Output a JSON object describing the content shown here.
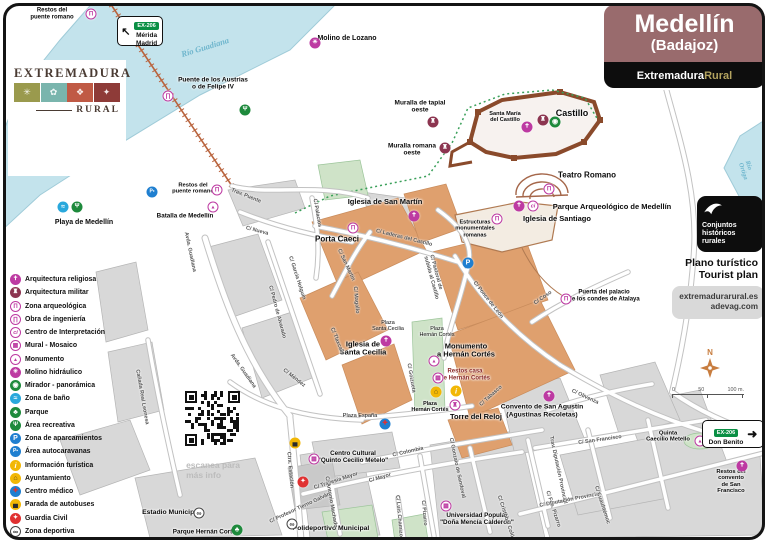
{
  "title": {
    "name": "Medellín",
    "region": "(Badajoz)",
    "brand_white": "Extremadura",
    "brand_gold": "Rural"
  },
  "panel": {
    "conjuntos": "Conjuntos\nhistóricos\nrurales",
    "plan": "Plano turístico\nTourist plan",
    "web1": "extremadurarural.es",
    "web2": "adevag.com"
  },
  "logos": {
    "extremadura": "EXTREMADURA",
    "rural": "RURAL",
    "redex": "redex",
    "redex_sub": "Red Extremeña de\nDesarrollo  Rural",
    "dip1": "DIPUTACIÓN",
    "dip2": "DE BADAJOZ",
    "tile_glyphs": [
      "✳",
      "✿",
      "❖",
      "✦"
    ]
  },
  "signs": [
    {
      "route": "EX-206",
      "lines": "Mérida\nMadrid",
      "arrow": "↖"
    },
    {
      "route": "EX-206",
      "lines": "Don Benito",
      "arrow": "➜"
    }
  ],
  "scale": {
    "north": "N",
    "t0": "0",
    "t50": "50",
    "t100": "100 m."
  },
  "qr_caption": "escanea para\nmás info",
  "rivers": [
    {
      "t": "Río Guadiana",
      "x": 205,
      "y": 47,
      "r": -17,
      "s": 8.5
    },
    {
      "t": "Río Ortiga",
      "x": 747,
      "y": 172,
      "r": 72,
      "s": 6.5
    }
  ],
  "icon_styles": {
    "religiosa": {
      "bg": "#bd3aa2",
      "fg": "#fff",
      "glyph": "✝"
    },
    "militar": {
      "bg": "#8c3550",
      "fg": "#fff",
      "glyph": "♜"
    },
    "arqueologica": {
      "bg": "#fff",
      "fg": "#bd3aa2",
      "br": "#bd3aa2",
      "glyph": "Π"
    },
    "ingenieria": {
      "bg": "#fff",
      "fg": "#bd3aa2",
      "br": "#bd3aa2",
      "glyph": "∏"
    },
    "ci": {
      "bg": "#fff",
      "fg": "#bd3aa2",
      "br": "#bd3aa2",
      "glyph": "ci",
      "it": 1,
      "fs": 5.5
    },
    "mural": {
      "bg": "#fff",
      "fg": "#bd3aa2",
      "br": "#bd3aa2",
      "glyph": "▦"
    },
    "monumento": {
      "bg": "#fff",
      "fg": "#bd3aa2",
      "br": "#bd3aa2",
      "glyph": "▲",
      "fs": 5
    },
    "torre": {
      "bg": "#fff",
      "fg": "#bd3aa2",
      "br": "#bd3aa2",
      "glyph": "♜"
    },
    "molino": {
      "bg": "#bd3aa2",
      "fg": "#fff",
      "glyph": "✳"
    },
    "mirador": {
      "bg": "#1e8a3c",
      "fg": "#fff",
      "glyph": "◉",
      "fs": 7
    },
    "bano": {
      "bg": "#29a8dc",
      "fg": "#fff",
      "glyph": "≈",
      "fs": 7
    },
    "parque": {
      "bg": "#1e8a3c",
      "fg": "#fff",
      "glyph": "♣",
      "fs": 7
    },
    "recreativa": {
      "bg": "#1e8a3c",
      "fg": "#fff",
      "glyph": "Ψ"
    },
    "aparcamiento": {
      "bg": "#1f7fd0",
      "fg": "#fff",
      "glyph": "P",
      "fs": 7
    },
    "autocaravana": {
      "bg": "#1f7fd0",
      "fg": "#fff",
      "glyph": "P▪",
      "fs": 5
    },
    "info": {
      "bg": "#f2b705",
      "fg": "#fff",
      "glyph": "i",
      "it": 1,
      "fs": 7.5
    },
    "ayuntamiento": {
      "bg": "#f2b705",
      "fg": "#5a4a1a",
      "glyph": "⌂",
      "fs": 7
    },
    "medico": {
      "bg": "#1f7fd0",
      "fg": "#e03131",
      "glyph": "✚"
    },
    "bus": {
      "bg": "#f2b705",
      "fg": "#2b2b2b",
      "glyph": "▄",
      "fs": 7
    },
    "guardia": {
      "bg": "#e03131",
      "fg": "#fff",
      "glyph": "✦"
    },
    "deportiva": {
      "bg": "#fff",
      "fg": "#222",
      "br": "#444",
      "glyph": "∞",
      "fs": 7
    }
  },
  "legend": {
    "items": [
      {
        "type": "religiosa",
        "label": "Arquitectura religiosa"
      },
      {
        "type": "militar",
        "label": "Arquitectura militar"
      },
      {
        "type": "arqueologica",
        "label": "Zona arqueológica"
      },
      {
        "type": "ingenieria",
        "label": "Obra de ingeniería"
      },
      {
        "type": "ci",
        "label": "Centro de Interpretación"
      },
      {
        "type": "mural",
        "label": "Mural - Mosaico"
      },
      {
        "type": "monumento",
        "label": "Monumento"
      },
      {
        "type": "molino",
        "label": "Molino hidráulico"
      },
      {
        "type": "mirador",
        "label": "Mirador - panorámica"
      },
      {
        "type": "bano",
        "label": "Zona de baño"
      },
      {
        "type": "parque",
        "label": "Parque"
      },
      {
        "type": "recreativa",
        "label": "Área recreativa"
      },
      {
        "type": "aparcamiento",
        "label": "Zona de aparcamientos"
      },
      {
        "type": "autocaravana",
        "label": "Área autocaravanas"
      },
      {
        "type": "info",
        "label": "Información turística"
      },
      {
        "type": "ayuntamiento",
        "label": "Ayuntamiento"
      },
      {
        "type": "medico",
        "label": "Centro médico"
      },
      {
        "type": "bus",
        "label": "Parada de autobuses"
      },
      {
        "type": "guardia",
        "label": "Guardia Civil"
      },
      {
        "type": "deportiva",
        "label": "Zona deportiva"
      }
    ]
  },
  "pois": [
    {
      "t": "Restos del\npuente romano",
      "x": 52,
      "y": 14,
      "s": 6
    },
    {
      "t": "Molino de Lozano",
      "x": 347,
      "y": 39,
      "s": 7
    },
    {
      "t": "Puente de los Austrias\no de Felipe IV",
      "x": 213,
      "y": 84,
      "s": 6.5
    },
    {
      "t": "Muralla de tapial\noeste",
      "x": 420,
      "y": 107,
      "s": 6.5
    },
    {
      "t": "Muralla romana\noeste",
      "x": 412,
      "y": 150,
      "s": 6.5
    },
    {
      "t": "Santa María\ndel Castillo",
      "x": 505,
      "y": 117,
      "s": 5.6
    },
    {
      "t": "Castillo",
      "x": 572,
      "y": 113,
      "s": 9
    },
    {
      "t": "Teatro Romano",
      "x": 587,
      "y": 176,
      "s": 8
    },
    {
      "t": "Parque Arqueológico de Medellín",
      "x": 612,
      "y": 207,
      "s": 7.5
    },
    {
      "t": "Iglesia de Santiago",
      "x": 557,
      "y": 219,
      "s": 7.5
    },
    {
      "t": "Estructuras\nmonumentales\nromanas",
      "x": 475,
      "y": 229,
      "s": 5.6
    },
    {
      "t": "Iglesia de San Martín",
      "x": 385,
      "y": 202,
      "s": 7.5
    },
    {
      "t": "Porta Caeci",
      "x": 337,
      "y": 240,
      "s": 8
    },
    {
      "t": "Puerta del palacio\nde los condes de Atalaya",
      "x": 604,
      "y": 296,
      "s": 6
    },
    {
      "t": "Iglesia de\nSanta Cecilia",
      "x": 363,
      "y": 349,
      "s": 7.5
    },
    {
      "t": "Plaza\nSanta Cecilia",
      "x": 388,
      "y": 326,
      "s": 5.4,
      "w": 400
    },
    {
      "t": "Plaza\nHernán Cortés",
      "x": 437,
      "y": 332,
      "s": 5.4,
      "w": 400
    },
    {
      "t": "Monumento\na Hernán Cortés",
      "x": 466,
      "y": 351,
      "s": 7.5
    },
    {
      "t": "Restos casa\nde Hernán Cortés",
      "x": 465,
      "y": 375,
      "s": 6,
      "c": "#8a2a2a"
    },
    {
      "t": "Plaza\nHernán Cortés",
      "x": 430,
      "y": 407,
      "s": 5.4
    },
    {
      "t": "Torre del Reloj",
      "x": 476,
      "y": 417,
      "s": 7.5
    },
    {
      "t": "Plaza España",
      "x": 360,
      "y": 416,
      "s": 5.6,
      "w": 400
    },
    {
      "t": "Convento de San Agustín\n(Agustinas Recoletas)",
      "x": 542,
      "y": 411,
      "s": 6.8
    },
    {
      "t": "Centro Cultural\n\"Quinto Cecilio Metelo\"",
      "x": 353,
      "y": 457,
      "s": 6.3
    },
    {
      "t": "Universidad Popular\n\"Doña Mencía Calderón\"",
      "x": 477,
      "y": 519,
      "s": 6.3
    },
    {
      "t": "Polideportivo Municipal",
      "x": 331,
      "y": 529,
      "s": 6.8
    },
    {
      "t": "Estadio Municipal",
      "x": 171,
      "y": 513,
      "s": 6.8
    },
    {
      "t": "Parque Hernán Cortés",
      "x": 206,
      "y": 532,
      "s": 6.3
    },
    {
      "t": "Quinta\nCaecilio Metello",
      "x": 668,
      "y": 437,
      "s": 5.8
    },
    {
      "t": "Restos del convento\nde San Francisco",
      "x": 731,
      "y": 482,
      "s": 5.8
    },
    {
      "t": "Playa de Medellín",
      "x": 84,
      "y": 223,
      "s": 7
    },
    {
      "t": "Restos del\npuente romano",
      "x": 193,
      "y": 189,
      "s": 5.8
    },
    {
      "t": "Batalla de Medellín",
      "x": 185,
      "y": 216,
      "s": 6.3
    }
  ],
  "streets": [
    {
      "t": "Trav. Puente",
      "x": 246,
      "y": 196,
      "r": 22
    },
    {
      "t": "C/ Nueva",
      "x": 257,
      "y": 231,
      "r": 15
    },
    {
      "t": "Avda. Guadiana",
      "x": 190,
      "y": 252,
      "r": 78
    },
    {
      "t": "Avda. Guadiana",
      "x": 243,
      "y": 371,
      "r": 55
    },
    {
      "t": "C/ Méndez",
      "x": 294,
      "y": 378,
      "r": 38
    },
    {
      "t": "C/ Pedro de Alvarado",
      "x": 277,
      "y": 312,
      "r": 75
    },
    {
      "t": "C/ García Holguín",
      "x": 297,
      "y": 278,
      "r": 72
    },
    {
      "t": "Cañada Real Leonesa",
      "x": 142,
      "y": 397,
      "r": 80
    },
    {
      "t": "Ctra. Estación",
      "x": 290,
      "y": 470,
      "r": 85
    },
    {
      "t": "C/ Tlaxcala",
      "x": 337,
      "y": 341,
      "r": 68
    },
    {
      "t": "C/ Goizueta",
      "x": 411,
      "y": 378,
      "r": 80
    },
    {
      "t": "C/ Palacios",
      "x": 317,
      "y": 213,
      "r": 80
    },
    {
      "t": "C/ San Martín",
      "x": 346,
      "y": 265,
      "r": 65
    },
    {
      "t": "C/ Laderas del Castillo",
      "x": 404,
      "y": 238,
      "r": 14
    },
    {
      "t": "C/ Magallo",
      "x": 356,
      "y": 300,
      "r": 85
    },
    {
      "t": "C/ Pastoral de\nsubida al Castillo",
      "x": 434,
      "y": 277,
      "r": 75
    },
    {
      "t": "C/ Ponce de León",
      "x": 488,
      "y": 300,
      "r": 52
    },
    {
      "t": "C/ Coso",
      "x": 543,
      "y": 298,
      "r": -35
    },
    {
      "t": "C/ Tabasco",
      "x": 491,
      "y": 396,
      "r": -42
    },
    {
      "t": "C/ Olivenza",
      "x": 585,
      "y": 397,
      "r": 25
    },
    {
      "t": "C/ San Francisco",
      "x": 600,
      "y": 440,
      "r": -8
    },
    {
      "t": "Trav. Diputación Provincial",
      "x": 558,
      "y": 470,
      "r": 78
    },
    {
      "t": "C/ Diputación Provincial",
      "x": 570,
      "y": 500,
      "r": -11
    },
    {
      "t": "C/ Colombia",
      "x": 408,
      "y": 452,
      "r": -13
    },
    {
      "t": "C/ Gonzalo de Sandoval",
      "x": 457,
      "y": 468,
      "r": 78
    },
    {
      "t": "C/ Travesía Mayor",
      "x": 336,
      "y": 481,
      "r": -18
    },
    {
      "t": "C/ Mayor",
      "x": 380,
      "y": 478,
      "r": -16
    },
    {
      "t": "C/ Antonio Machado",
      "x": 331,
      "y": 502,
      "r": 80
    },
    {
      "t": "C/ Profesor Tierno Galván",
      "x": 300,
      "y": 508,
      "r": -25
    },
    {
      "t": "C/ Luis Chamizo",
      "x": 399,
      "y": 516,
      "r": 85
    },
    {
      "t": "C/ Pizarro",
      "x": 424,
      "y": 513,
      "r": 85
    },
    {
      "t": "C/ Cristóbal Colón",
      "x": 506,
      "y": 518,
      "r": 72
    },
    {
      "t": "C/ Fco. Pizarro",
      "x": 553,
      "y": 509,
      "r": 72
    },
    {
      "t": "C/ Cuauhtémoc",
      "x": 602,
      "y": 505,
      "r": 72
    }
  ],
  "map_icons": [
    {
      "type": "arqueologica",
      "x": 91,
      "y": 14
    },
    {
      "type": "arqueologica",
      "x": 217,
      "y": 190
    },
    {
      "type": "arqueologica",
      "x": 353,
      "y": 228
    },
    {
      "type": "arqueologica",
      "x": 497,
      "y": 219
    },
    {
      "type": "arqueologica",
      "x": 549,
      "y": 189
    },
    {
      "type": "arqueologica",
      "x": 566,
      "y": 299
    },
    {
      "type": "ingenieria",
      "x": 168,
      "y": 96
    },
    {
      "type": "molino",
      "x": 315,
      "y": 43
    },
    {
      "type": "militar",
      "x": 433,
      "y": 122
    },
    {
      "type": "militar",
      "x": 445,
      "y": 148
    },
    {
      "type": "militar",
      "x": 543,
      "y": 120
    },
    {
      "type": "mirador",
      "x": 555,
      "y": 122
    },
    {
      "type": "religiosa",
      "x": 527,
      "y": 127
    },
    {
      "type": "religiosa",
      "x": 519,
      "y": 206
    },
    {
      "type": "ci",
      "x": 533,
      "y": 206
    },
    {
      "type": "religiosa",
      "x": 414,
      "y": 216
    },
    {
      "type": "religiosa",
      "x": 386,
      "y": 341
    },
    {
      "type": "religiosa",
      "x": 549,
      "y": 396
    },
    {
      "type": "religiosa",
      "x": 742,
      "y": 466
    },
    {
      "type": "monumento",
      "x": 213,
      "y": 207
    },
    {
      "type": "monumento",
      "x": 434,
      "y": 361
    },
    {
      "type": "monumento",
      "x": 700,
      "y": 441
    },
    {
      "type": "mural",
      "x": 438,
      "y": 378
    },
    {
      "type": "mural",
      "x": 314,
      "y": 459
    },
    {
      "type": "mural",
      "x": 446,
      "y": 506
    },
    {
      "type": "torre",
      "x": 455,
      "y": 405
    },
    {
      "type": "bano",
      "x": 63,
      "y": 207
    },
    {
      "type": "recreativa",
      "x": 77,
      "y": 207
    },
    {
      "type": "recreativa",
      "x": 245,
      "y": 110
    },
    {
      "type": "parque",
      "x": 237,
      "y": 530
    },
    {
      "type": "aparcamiento",
      "x": 468,
      "y": 263
    },
    {
      "type": "autocaravana",
      "x": 152,
      "y": 192
    },
    {
      "type": "info",
      "x": 456,
      "y": 391
    },
    {
      "type": "ayuntamiento",
      "x": 436,
      "y": 392
    },
    {
      "type": "medico",
      "x": 385,
      "y": 424
    },
    {
      "type": "bus",
      "x": 295,
      "y": 443
    },
    {
      "type": "guardia",
      "x": 303,
      "y": 482
    },
    {
      "type": "deportiva",
      "x": 199,
      "y": 513
    },
    {
      "type": "deportiva",
      "x": 292,
      "y": 524
    }
  ]
}
